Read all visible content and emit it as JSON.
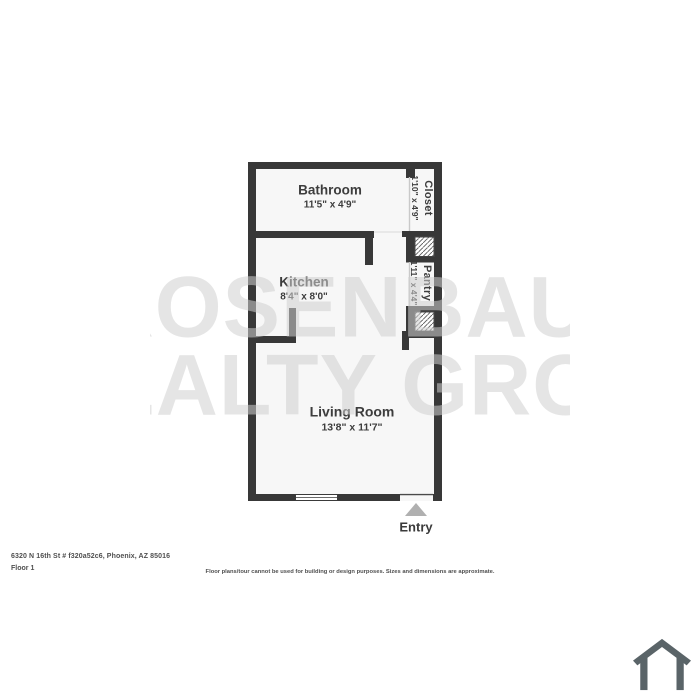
{
  "floorplan": {
    "rooms": [
      {
        "name": "Bathroom",
        "dims": "11'5\" x 4'9\""
      },
      {
        "name": "Closet",
        "dims": "1'10\" x 4'9\""
      },
      {
        "name": "Kitchen",
        "dims": "8'4\" x 8'0\""
      },
      {
        "name": "Pantry",
        "dims": "1'11\" x 4'4\""
      },
      {
        "name": "Living Room",
        "dims": "13'8\" x 11'7\""
      }
    ],
    "entry_label": "Entry"
  },
  "watermark": {
    "line1": "ROSENBAUM",
    "line2": "REALTY GROUP"
  },
  "footer": {
    "address": "6320 N 16th St # f320a52c6, Phoenix, AZ 85016",
    "floor": "Floor 1",
    "disclaimer": "Floor plans/tour cannot be used for building or design purposes. Sizes and dimensions are approximate."
  },
  "icons": {
    "entry_arrow": "up-triangle-icon",
    "logo": "house-icon"
  },
  "colors": {
    "wall": "#383838",
    "room_fill": "#f7f7f7",
    "label_text": "#3d3d3d",
    "entry_arrow": "#b0b0b0",
    "logo": "#5a6468",
    "watermark": "#e3e3e3"
  }
}
